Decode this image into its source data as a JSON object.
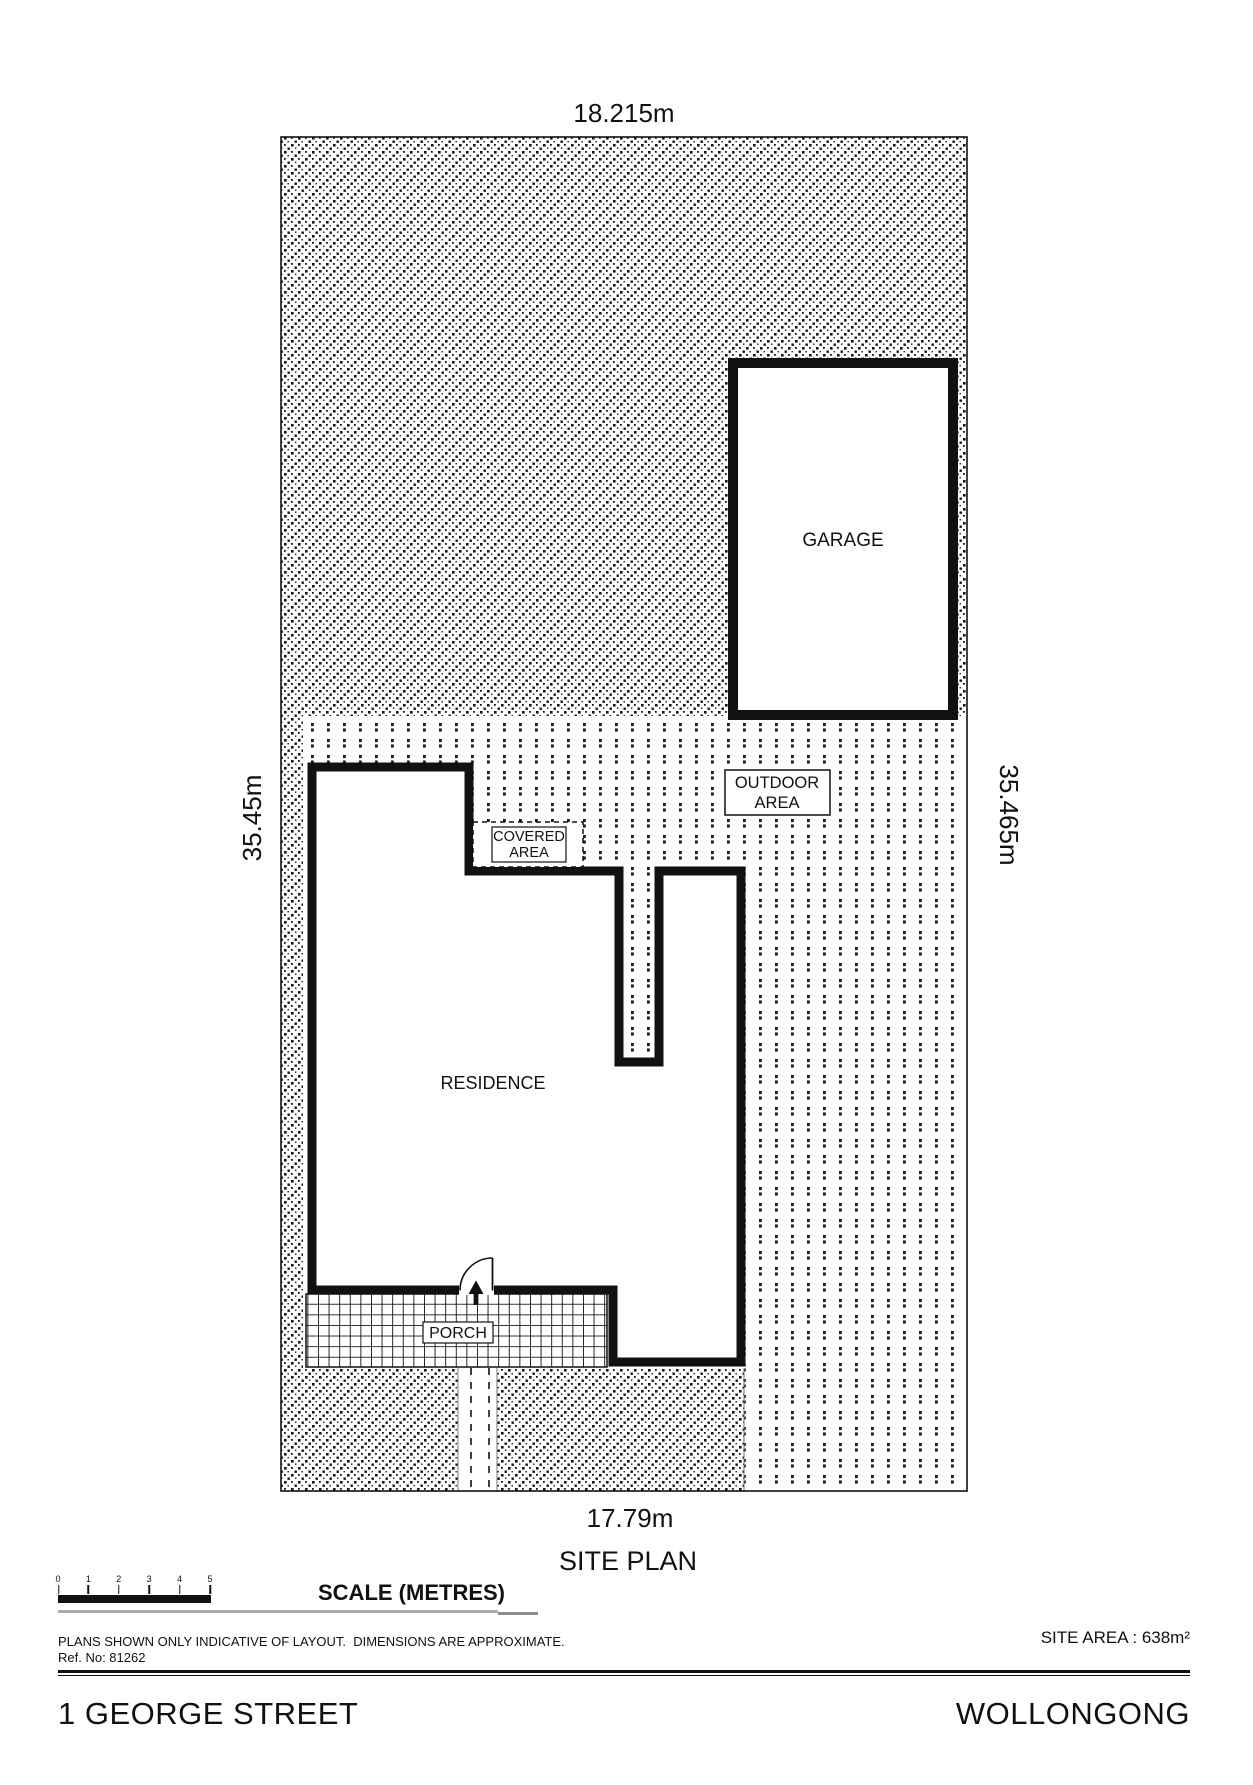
{
  "plan": {
    "title": "SITE PLAN",
    "dim_top": "18.215m",
    "dim_left": "35.45m",
    "dim_right": "35.465m",
    "dim_bottom": "17.79m",
    "garage": "GARAGE",
    "residence": "RESIDENCE",
    "porch": "PORCH",
    "outdoor_line1": "OUTDOOR",
    "outdoor_line2": "AREA",
    "covered_line1": "COVERED",
    "covered_line2": "AREA"
  },
  "scale_bar": {
    "ticks": [
      "0",
      "1",
      "2",
      "3",
      "4",
      "5"
    ],
    "caption": "SCALE (METRES)"
  },
  "notes": {
    "disclaimer": "PLANS SHOWN ONLY INDICATIVE OF LAYOUT.  DIMENSIONS ARE APPROXIMATE.",
    "ref": "Ref. No: 81262",
    "site_area": "SITE AREA : 638m²"
  },
  "footer": {
    "street": "1 GEORGE STREET",
    "suburb": "WOLLONGONG"
  },
  "colors": {
    "ink": "#111111",
    "grey": "#ababab"
  }
}
